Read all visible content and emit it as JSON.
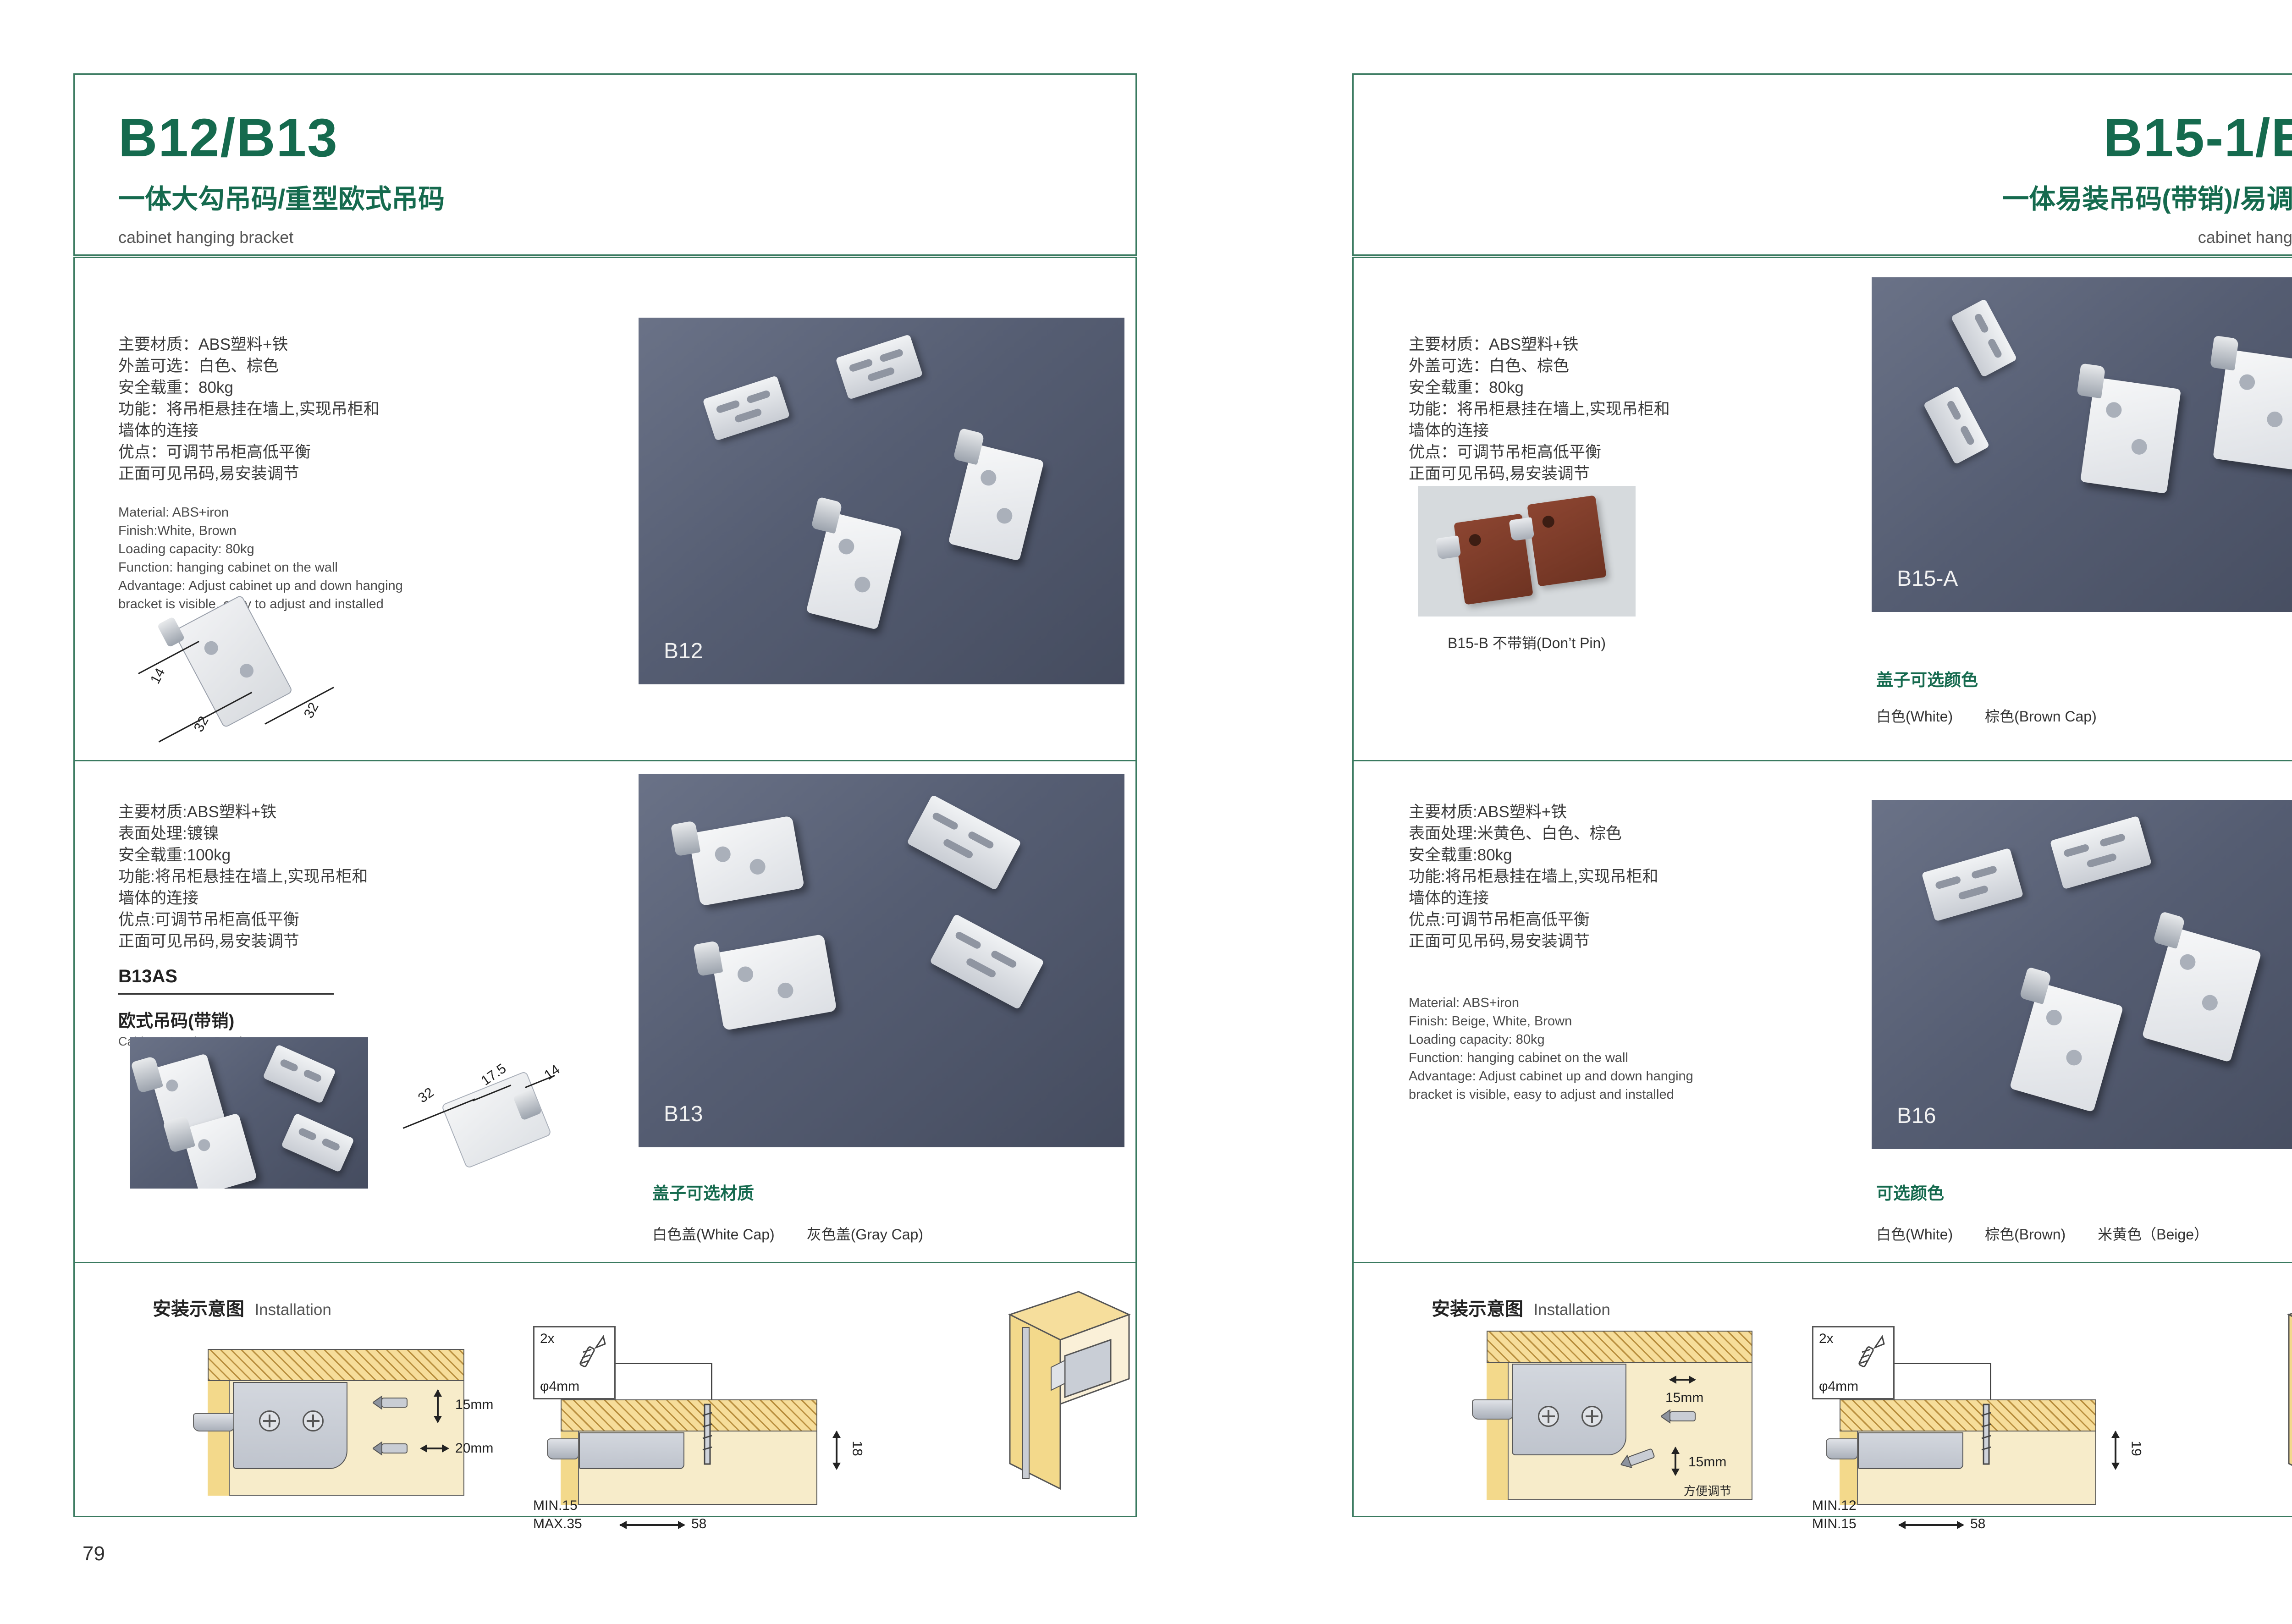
{
  "theme": {
    "accent_green": "#156a4e",
    "border_green": "#3a7a60",
    "photo_bg": "#555d72"
  },
  "left_page": {
    "title": "B12/B13",
    "subtitle": "一体大勾吊码/重型欧式吊码",
    "category_en": "cabinet hanging bracket",
    "page_number": "79",
    "section1": {
      "specs_cn": [
        "主要材质：ABS塑料+铁",
        "外盖可选：白色、棕色",
        "安全载重：80kg",
        "功能：将吊柜悬挂在墙上,实现吊柜和",
        "墙体的连接",
        "优点：可调节吊柜高低平衡",
        "正面可见吊码,易安装调节"
      ],
      "specs_en": [
        "Material: ABS+iron",
        "Finish:White, Brown",
        "Loading capacity: 80kg",
        "Function: hanging cabinet on the wall",
        "Advantage: Adjust cabinet up and down hanging",
        "bracket is visible, easy to adjust and installed"
      ],
      "dims": [
        "14",
        "32",
        "32"
      ],
      "image_label": "B12"
    },
    "section2": {
      "specs_cn": [
        "主要材质:ABS塑料+铁",
        "表面处理:镀镍",
        "安全载重:100kg",
        "功能:将吊柜悬挂在墙上,实现吊柜和",
        "墙体的连接",
        "优点:可调节吊柜高低平衡",
        "正面可见吊码,易安装调节"
      ],
      "model_code": "B13AS",
      "model_cn": "欧式吊码(带销)",
      "model_en": "Cabinet Hanging Brcaket",
      "dims": [
        "32",
        "17.5",
        "14"
      ],
      "image_label": "B13",
      "cap_title": "盖子可选材质",
      "cap_options": [
        "白色盖(White Cap)",
        "灰色盖(Gray Cap)"
      ]
    },
    "installation": {
      "title_cn": "安装示意图",
      "title_en": "Installation",
      "d1_dim_top": "15mm",
      "d1_dim_bottom": "20mm",
      "callout_qty": "2x",
      "callout_dia": "φ4mm",
      "d2_dim_side": "18",
      "d2_min": "MIN.15",
      "d2_max": "MAX.35",
      "d2_width": "58"
    }
  },
  "right_page": {
    "title": "B15-1/B16",
    "subtitle": "一体易装吊码(带销)/易调节吊码",
    "category_en": "cabinet hanging bracket",
    "page_number": "80",
    "section1": {
      "specs_cn": [
        "主要材质：ABS塑料+铁",
        "外盖可选：白色、棕色",
        "安全载重：80kg",
        "功能：将吊柜悬挂在墙上,实现吊柜和",
        "墙体的连接",
        "优点：可调节吊柜高低平衡",
        "正面可见吊码,易安装调节"
      ],
      "small_caption": "B15-B 不带销(Don’t Pin)",
      "image_label": "B15-A",
      "cap_title": "盖子可选颜色",
      "cap_options": [
        "白色(White)",
        "棕色(Brown Cap)"
      ]
    },
    "section2": {
      "specs_cn": [
        "主要材质:ABS塑料+铁",
        "表面处理:米黄色、白色、棕色",
        "安全载重:80kg",
        "功能:将吊柜悬挂在墙上,实现吊柜和",
        "墙体的连接",
        "优点:可调节吊柜高低平衡",
        "正面可见吊码,易安装调节"
      ],
      "specs_en": [
        "Material: ABS+iron",
        "Finish: Beige, White, Brown",
        "Loading capacity: 80kg",
        "Function: hanging cabinet on the wall",
        "Advantage: Adjust cabinet up and down hanging",
        "bracket is visible, easy to adjust and installed"
      ],
      "image_label": "B16",
      "cap_title": "可选颜色",
      "cap_options": [
        "白色(White)",
        "棕色(Brown)",
        "米黄色（Beige）"
      ]
    },
    "installation": {
      "title_cn": "安装示意图",
      "title_en": "Installation",
      "d1_dim_top": "15mm",
      "d1_dim_bottom": "15mm",
      "d1_note": "方便调节",
      "callout_qty": "2x",
      "callout_dia": "φ4mm",
      "d2_dim_side": "19",
      "d2_min": "MIN.12",
      "d2_max": "MIN.15",
      "d2_width": "58"
    }
  }
}
